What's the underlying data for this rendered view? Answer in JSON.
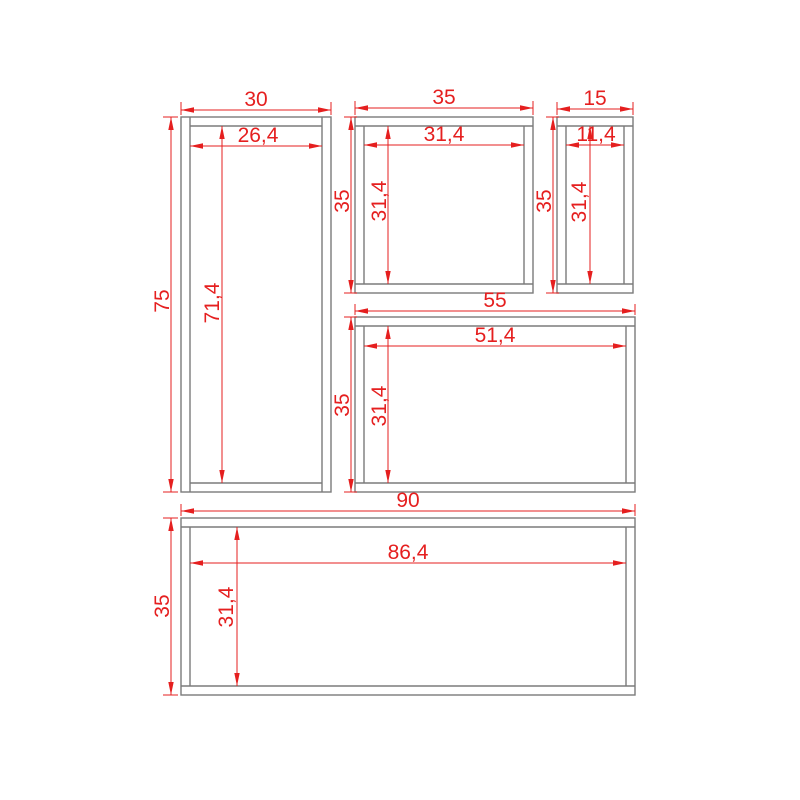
{
  "drawing": {
    "title": "frame-parts-dimension-drawing",
    "background": "#ffffff",
    "stroke_color": "#7b7b7b",
    "dim_color": "#e51f1f",
    "font_size": 21,
    "frames": [
      {
        "id": "tall-cabinet",
        "construction": "sides-full",
        "outer": [
          181,
          117,
          150,
          375
        ],
        "inner": [
          190,
          126,
          132,
          357
        ],
        "labels": {
          "outer_width": "30",
          "inner_width": "26,4",
          "outer_height": "75",
          "inner_height": "71,4"
        }
      },
      {
        "id": "top-middle-box",
        "construction": "topbottom-full",
        "outer": [
          355,
          117,
          178,
          176
        ],
        "inner": [
          364,
          126,
          160,
          158
        ],
        "labels": {
          "outer_width": "35",
          "inner_width": "31,4",
          "outer_height": "35",
          "inner_height": "31,4"
        }
      },
      {
        "id": "top-right-box",
        "construction": "topbottom-full",
        "outer": [
          557,
          117,
          76,
          176
        ],
        "inner": [
          566,
          126,
          58,
          158
        ],
        "labels": {
          "outer_width": "15",
          "inner_width": "11,4",
          "outer_height": "35",
          "inner_height": "31,4"
        }
      },
      {
        "id": "middle-wide-box",
        "construction": "topbottom-full",
        "outer": [
          355,
          317,
          280,
          175
        ],
        "inner": [
          364,
          326,
          262,
          157
        ],
        "labels": {
          "outer_width": "55",
          "inner_width": "51,4",
          "outer_height": "35",
          "inner_height": "31,4"
        }
      },
      {
        "id": "bottom-wide-box",
        "construction": "topbottom-full",
        "outer": [
          181,
          518,
          454,
          177
        ],
        "inner": [
          190,
          527,
          436,
          159
        ],
        "labels": {
          "outer_width": "90",
          "inner_width": "86,4",
          "outer_height": "35",
          "inner_height": "31,4"
        }
      }
    ],
    "dimensions": [
      {
        "id": "dim-tall-outer-width",
        "label": "30",
        "axis": "h",
        "pos": 110,
        "from": 181,
        "to": 331,
        "text": [
          256,
          106
        ],
        "ext": [
          [
            181,
            102,
            181,
            115
          ],
          [
            331,
            102,
            331,
            115
          ]
        ]
      },
      {
        "id": "dim-tall-inner-width",
        "label": "26,4",
        "axis": "h",
        "pos": 146,
        "from": 190,
        "to": 322,
        "text": [
          258,
          142
        ],
        "ext": []
      },
      {
        "id": "dim-tall-outer-height",
        "label": "75",
        "axis": "v",
        "pos": 171,
        "from": 117,
        "to": 492,
        "text": [
          169,
          301
        ],
        "ext": [
          [
            163,
            117,
            178,
            117
          ],
          [
            163,
            492,
            178,
            492
          ]
        ]
      },
      {
        "id": "dim-tall-inner-height",
        "label": "71,4",
        "axis": "v",
        "pos": 222,
        "from": 126,
        "to": 483,
        "text": [
          219,
          303
        ],
        "ext": []
      },
      {
        "id": "dim-topmid-outer-width",
        "label": "35",
        "axis": "h",
        "pos": 108,
        "from": 355,
        "to": 533,
        "text": [
          444,
          104
        ],
        "ext": [
          [
            355,
            101,
            355,
            115
          ],
          [
            533,
            101,
            533,
            115
          ]
        ]
      },
      {
        "id": "dim-topmid-inner-width",
        "label": "31,4",
        "axis": "h",
        "pos": 145,
        "from": 364,
        "to": 524,
        "text": [
          444,
          141
        ],
        "ext": []
      },
      {
        "id": "dim-topmid-outer-height",
        "label": "35",
        "axis": "v",
        "pos": 351,
        "from": 117,
        "to": 293,
        "text": [
          349,
          201
        ],
        "ext": [
          [
            344,
            117,
            357,
            117
          ],
          [
            344,
            293,
            357,
            293
          ]
        ]
      },
      {
        "id": "dim-topmid-inner-height",
        "label": "31,4",
        "axis": "v",
        "pos": 388,
        "from": 126,
        "to": 284,
        "text": [
          386,
          201
        ],
        "ext": []
      },
      {
        "id": "dim-topright-outer-width",
        "label": "15",
        "axis": "h",
        "pos": 109,
        "from": 557,
        "to": 633,
        "text": [
          595,
          105
        ],
        "ext": [
          [
            557,
            102,
            557,
            115
          ],
          [
            633,
            102,
            633,
            115
          ]
        ]
      },
      {
        "id": "dim-topright-inner-width",
        "label": "11,4",
        "axis": "h",
        "pos": 145,
        "from": 566,
        "to": 624,
        "text": [
          596,
          141
        ],
        "ext": []
      },
      {
        "id": "dim-topright-outer-height",
        "label": "35",
        "axis": "v",
        "pos": 553,
        "from": 117,
        "to": 293,
        "text": [
          551,
          201
        ],
        "ext": [
          [
            546,
            117,
            559,
            117
          ],
          [
            546,
            293,
            559,
            293
          ]
        ]
      },
      {
        "id": "dim-topright-inner-height",
        "label": "31,4",
        "axis": "v",
        "pos": 590,
        "from": 126,
        "to": 284,
        "text": [
          586,
          202
        ],
        "ext": []
      },
      {
        "id": "dim-midwide-outer-width",
        "label": "55",
        "axis": "h",
        "pos": 311,
        "from": 355,
        "to": 635,
        "text": [
          495,
          307
        ],
        "ext": [
          [
            355,
            304,
            355,
            315
          ],
          [
            635,
            304,
            635,
            315
          ]
        ]
      },
      {
        "id": "dim-midwide-inner-width",
        "label": "51,4",
        "axis": "h",
        "pos": 346,
        "from": 364,
        "to": 626,
        "text": [
          495,
          342
        ],
        "ext": []
      },
      {
        "id": "dim-midwide-outer-height",
        "label": "35",
        "axis": "v",
        "pos": 351,
        "from": 317,
        "to": 492,
        "text": [
          349,
          405
        ],
        "ext": [
          [
            344,
            317,
            357,
            317
          ],
          [
            344,
            492,
            357,
            492
          ]
        ]
      },
      {
        "id": "dim-midwide-inner-height",
        "label": "31,4",
        "axis": "v",
        "pos": 388,
        "from": 326,
        "to": 483,
        "text": [
          386,
          406
        ],
        "ext": []
      },
      {
        "id": "dim-bottom-outer-width",
        "label": "90",
        "axis": "h",
        "pos": 511,
        "from": 181,
        "to": 635,
        "text": [
          408,
          507
        ],
        "ext": [
          [
            181,
            504,
            181,
            516
          ],
          [
            635,
            504,
            635,
            516
          ]
        ]
      },
      {
        "id": "dim-bottom-inner-width",
        "label": "86,4",
        "axis": "h",
        "pos": 563,
        "from": 190,
        "to": 626,
        "text": [
          408,
          559
        ],
        "ext": []
      },
      {
        "id": "dim-bottom-outer-height",
        "label": "35",
        "axis": "v",
        "pos": 171,
        "from": 518,
        "to": 695,
        "text": [
          169,
          606
        ],
        "ext": [
          [
            163,
            518,
            178,
            518
          ],
          [
            163,
            695,
            178,
            695
          ]
        ]
      },
      {
        "id": "dim-bottom-inner-height",
        "label": "31,4",
        "axis": "v",
        "pos": 237,
        "from": 527,
        "to": 686,
        "text": [
          233,
          607
        ],
        "ext": []
      }
    ]
  }
}
